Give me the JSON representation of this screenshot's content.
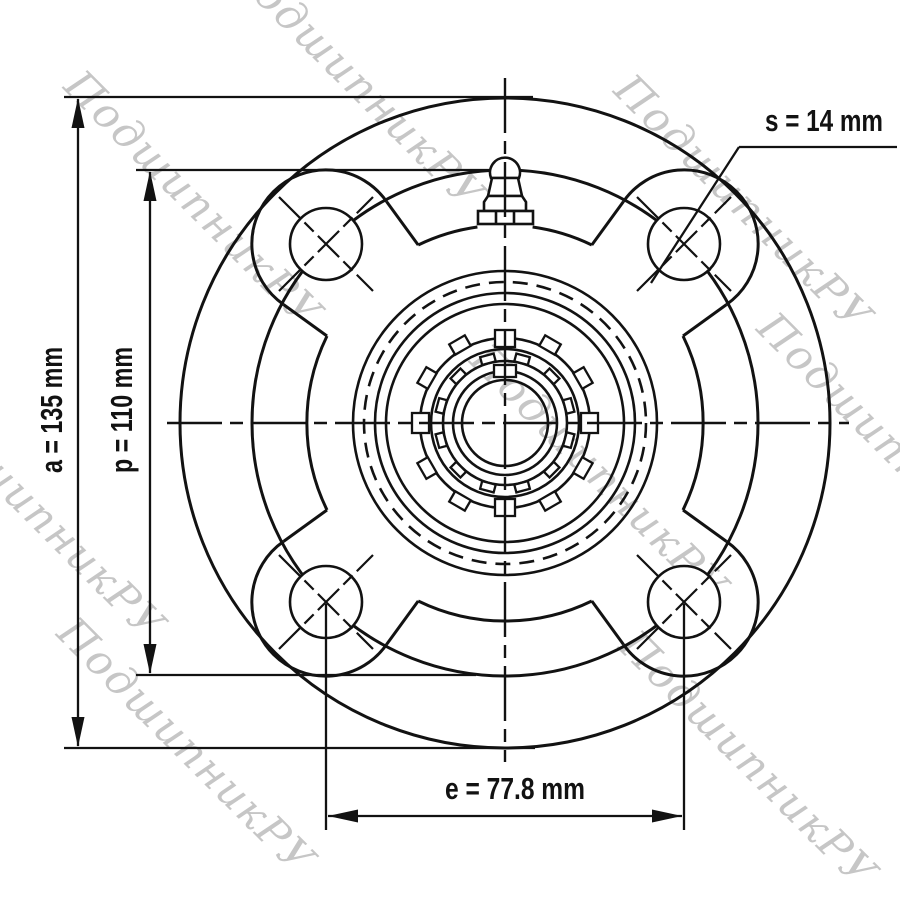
{
  "drawing": {
    "view": "front",
    "dimensions": [
      {
        "id": "a",
        "label": "a = 135 mm",
        "value": 135,
        "unit": "mm"
      },
      {
        "id": "p",
        "label": "p = 110 mm",
        "value": 110,
        "unit": "mm"
      },
      {
        "id": "e",
        "label": "e = 77.8 mm",
        "value": 77.8,
        "unit": "mm"
      },
      {
        "id": "s",
        "label": "s = 14 mm",
        "value": 14,
        "unit": "mm"
      }
    ],
    "bolt_hole_count": 4
  },
  "watermark": {
    "text": "ПодшипникРУ",
    "color": "#c6c6c6"
  },
  "colors": {
    "line": "#121212",
    "background": "#ffffff"
  }
}
